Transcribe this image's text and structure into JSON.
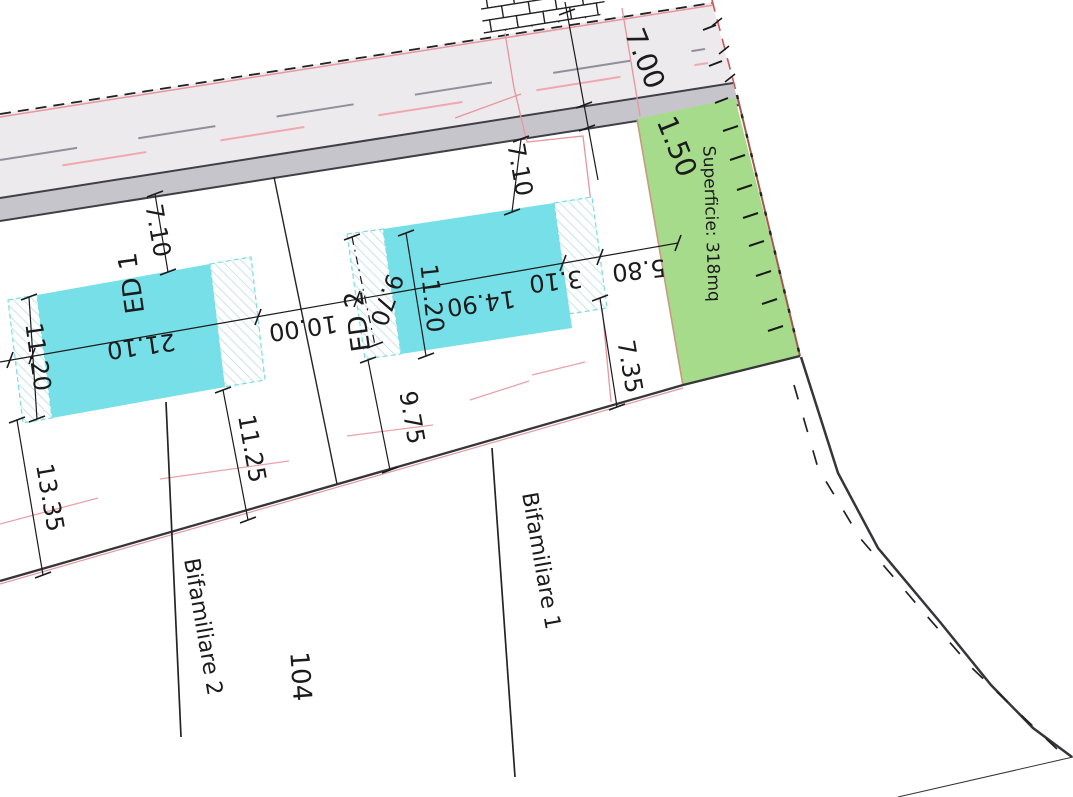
{
  "labels": {
    "superficie": "Superficie: 318mq",
    "bifamiliare1": "Bifamiliare 1",
    "bifamiliare2": "Bifamiliare 2",
    "parcel_104": "104",
    "ed1": "ED 1",
    "ed2": "ED 2"
  },
  "dimensions": {
    "road_width": "7.00",
    "sidewalk_width": "1.50",
    "gap_road_ed1": "7.10",
    "gap_road_ed2": "7.10",
    "ed1_length": "21.10",
    "ed1_width": "11.20",
    "ed1_left_offset": "11.20",
    "ed1_to_boundary_left": "13.35",
    "ed1_to_boundary_right": "11.25",
    "gap_ed1_ed2": "10.00",
    "ed2_side_offset": "9.75",
    "ed2_hatch_width": "9.70",
    "ed2_width": "11.20",
    "ed2_length": "14.90",
    "ed2_to_pink_boundary": "3.10",
    "pink_boundary_to_green": "5.80",
    "green_to_boundary": "7.35"
  },
  "colors": {
    "building": "#76dfe8",
    "green_area": "#a6db8b",
    "text_green": "#3f8c2f",
    "asphalt": "#eceaed",
    "sidewalk": "#c6c5cb",
    "boundary_pink": "#e8959e"
  }
}
